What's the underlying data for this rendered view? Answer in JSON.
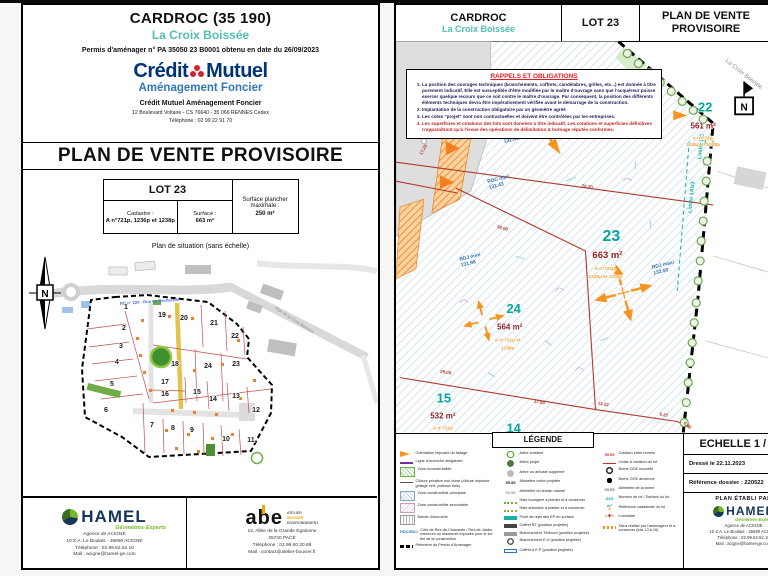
{
  "colors": {
    "teal": "#00a59b",
    "maroon": "#8e1b1b",
    "orange_cad": "#f2a033",
    "red_line": "#b03a2a",
    "cm_navy": "#00337a",
    "hamel_green": "#76b82a"
  },
  "left": {
    "title": "CARDROC (35 190)",
    "subtitle": "La Croix Boissée",
    "permit": "Permis d'aménager n° PA 35050 23 B0001 obtenu en date du 26/09/2023",
    "cm_logo": {
      "word1": "Crédit",
      "word2": "Mutuel",
      "tagline": "Aménagement Foncier"
    },
    "company": "Crédit Mutuel Aménagement Foncier",
    "company_address": "12 Boulevard Voltaire - CS 76640 - 35 066 RENNES Cedex",
    "company_phone": "Téléphone : 02 99 22 91 70",
    "doc_title": "PLAN DE VENTE PROVISOIRE",
    "lot_box": {
      "lot": "LOT 23",
      "cadastre_label": "Cadastre :",
      "cadastre_value": "A n°721p, 1236p et 1238p",
      "surface_label": "Surface :",
      "surface_value": "663 m²",
      "floor_label": "Surface plancher maximale :",
      "floor_value": "250 m²"
    },
    "map_caption": "Plan de situation (sans échelle)",
    "map": {
      "north": "N",
      "road_label": "RD n° 220 - Rue de Bécherelle",
      "street_label": "Rue de la Croix Boissée",
      "lots": [
        "1",
        "2",
        "3",
        "4",
        "5",
        "6",
        "7",
        "8",
        "9",
        "10",
        "11",
        "12",
        "13",
        "14",
        "15",
        "16",
        "17",
        "18",
        "19",
        "20",
        "21",
        "22",
        "23",
        "24"
      ]
    },
    "footer": {
      "hamel": {
        "name": "HAMEL",
        "tagline": "Géomètres-Experts",
        "lines": [
          "Agence de ACIGNÉ",
          "10 Z.A. Le Boulais - 35690 ACIGNÉ",
          "Téléphone : 02.99.62.52.10",
          "Mail : acigne@hamel-ge.com"
        ]
      },
      "abe": {
        "name": "abe",
        "tags": [
          "ATELIER",
          "BOUVIER",
          "ENVIRONNEMENT"
        ],
        "lines": [
          "12, Allée de la Grande Egalonne",
          "35740 PACÉ",
          "Téléphone : 02.99.60.20.68",
          "Mail : contact@atelier-bouvier.fr"
        ]
      }
    }
  },
  "right": {
    "header": {
      "city": "CARDROC",
      "place": "La Croix Boissée",
      "lot": "LOT 23",
      "doc": "PLAN DE VENTE PROVISOIRE"
    },
    "notice": {
      "title": "RAPPELS ET OBLIGATIONS",
      "items": [
        {
          "t": "La position des ouvrages techniques (branchements, coffrets, candélabres, grilles, etc...) est donnée à titre purement indicatif. Elle est susceptible d'être modifiée par le maître d'ouvrage sans que l'acquéreur puisse exercer quelque recours que ce soit contre le maître d'ouvrage. Par conséquent, la position des différents éléments techniques devra être impérativement vérifiée avant le démarrage de la construction.",
          "cls": ""
        },
        {
          "t": "Implantation de la construction obligatoire par un géomètre agréé",
          "cls": ""
        },
        {
          "t": "Les cotes \"projet\" sont non contractuelles et doivent être contrôlées par les entreprises.",
          "cls": ""
        },
        {
          "t": "Les superficies et cotations des lots sont données à titre indicatif. Les cotations et superficies définitives n'apparaîtront qu'à l'issue des opérations de délimitation & bornage réputés conformes.",
          "cls": "red"
        }
      ]
    },
    "plan": {
      "north": "N",
      "street": "La Croix Boissée",
      "limits": [
        "Limite UC",
        "Limite 1AU3"
      ],
      "lots": [
        {
          "num": "22",
          "area": "561 m²",
          "cad1": "A n°721p,",
          "cad2": "1236p et 1238p"
        },
        {
          "num": "23",
          "area": "663 m²",
          "cad1": "A n°721p,",
          "cad2": "1236p et 1238p"
        },
        {
          "num": "24",
          "area": "564 m²",
          "cad1": "A n°721p et",
          "cad2": "1238p"
        },
        {
          "num": "15",
          "area": "532 m²",
          "cad1": "A n°721p",
          "cad2": ""
        },
        {
          "num": "14",
          "area": "",
          "cad1": "",
          "cad2": ""
        }
      ],
      "notes": [
        {
          "l1": "RDC mini",
          "l2": "132.86"
        },
        {
          "l1": "RDC mini",
          "l2": "132.43"
        },
        {
          "l1": "RDJ maxi",
          "l2": "132.50"
        },
        {
          "l1": "RDJ mini",
          "l2": "131.98"
        }
      ],
      "dims": [
        "76.20",
        "30.00",
        "29.00",
        "17.00",
        "13.22",
        "5.27",
        "6.85",
        "17.25"
      ]
    },
    "legend": {
      "title": "LÉGENDE",
      "col1": [
        {
          "cls": "lg-orientation",
          "sym": "",
          "label": "Orientation imposée du faîtage"
        },
        {
          "cls": "lg-ligne",
          "sym": "",
          "label": "Ligne d'accroche obligatoire"
        },
        {
          "cls": "lg-zone-incon",
          "sym": "",
          "label": "Zone inconstructible"
        },
        {
          "cls": "lg-cloture",
          "sym": "",
          "label": "Clôture privative non close (clôture imposée : grillage vert, poteaux bois)"
        },
        {
          "cls": "lg-zone-p",
          "sym": "",
          "label": "Zone constructible principale"
        },
        {
          "cls": "lg-zone-s",
          "sym": "",
          "label": "Zone constructible secondaire"
        },
        {
          "cls": "lg-bande",
          "sym": "",
          "label": "Bande d'accroche"
        },
        {
          "cls": "lg-rdc",
          "sym": "RDC/RDJ",
          "label": "Côte de Rez-de-Chaussée / Rez-de-Jardin minimum ou maximum imposée pour le sol fini de la construction"
        },
        {
          "cls": "lg-perimetre",
          "sym": "",
          "label": "Périmètre du Permis d'Aménager"
        }
      ],
      "col2": [
        {
          "cls": "lg-arbre-e",
          "sym": "",
          "label": "Arbre existant"
        },
        {
          "cls": "lg-arbre-p",
          "sym": "",
          "label": "Arbre projet"
        },
        {
          "cls": "lg-arbre-s",
          "sym": "",
          "label": "Arbre ou arbuste supprimé"
        },
        {
          "cls": "lg-alti-v",
          "sym": "55.55",
          "label": "Altimétrie voirie projetée"
        },
        {
          "cls": "lg-alti-t",
          "sym": "55.55",
          "label": "Altimétrie du terrain naturel"
        },
        {
          "cls": "lg-haie-b",
          "sym": "",
          "label": "Haie bocagère à planter et à conserver"
        },
        {
          "cls": "lg-haie-a",
          "sym": "",
          "label": "Haie arbustive à planter et à conserver"
        },
        {
          "cls": "lg-ep",
          "sym": "",
          "label": "Point de rejet des EP en surface"
        },
        {
          "cls": "lg-bt",
          "sym": "",
          "label": "Coffret BT (position projetée)"
        },
        {
          "cls": "lg-tel",
          "sym": "",
          "label": "Branchement Télécom (position projetée)"
        },
        {
          "cls": "lg-eu",
          "sym": "",
          "label": "Branchement E.U (position projetée)"
        },
        {
          "cls": "lg-aep",
          "sym": "",
          "label": "Coffret A.E.P (position projetée)"
        }
      ],
      "col3": [
        {
          "cls": "lg-cot",
          "sym": "55.55",
          "label": "Cotation entre bornes"
        },
        {
          "cls": "lg-lim",
          "sym": "",
          "label": "Limite & cotation du lot"
        },
        {
          "cls": "lg-borne-n",
          "sym": "",
          "label": "Borne OGE nouvelle"
        },
        {
          "cls": "lg-borne-a",
          "sym": "",
          "label": "Borne OGE ancienne"
        },
        {
          "cls": "lg-alti-b",
          "sym": "55.55",
          "label": "Altimétrie de la borne"
        },
        {
          "cls": "lg-num",
          "sym": "XXX m²",
          "label": "Numéro de lot / Surface du lot"
        },
        {
          "cls": "lg-ref",
          "sym": "A n°XX",
          "label": "Référence cadastrale du lot"
        },
        {
          "cls": "lg-lum",
          "sym": "+",
          "label": "Luminaire"
        },
        {
          "cls": "lg-talus",
          "sym": "",
          "label": "Talus réalisé par l'aménageur et à conserver (lots 13 à 16)"
        }
      ]
    },
    "info": {
      "scale": "ECHELLE 1 / 250",
      "date": "Dressé le 22.11.2023",
      "ref": "Référence dossier : 220522",
      "made_by": "PLAN ÉTABLI PAR",
      "hamel": {
        "name": "HAMEL",
        "tagline": "Géomètres-Experts",
        "lines": [
          "Agence de ACIGNÉ",
          "10 Z.A. Le Boulais - 35690 ACIGNÉ",
          "Téléphone : 02.99.62.52.10",
          "Mail : acigne@hamel-ge.com"
        ]
      }
    }
  }
}
